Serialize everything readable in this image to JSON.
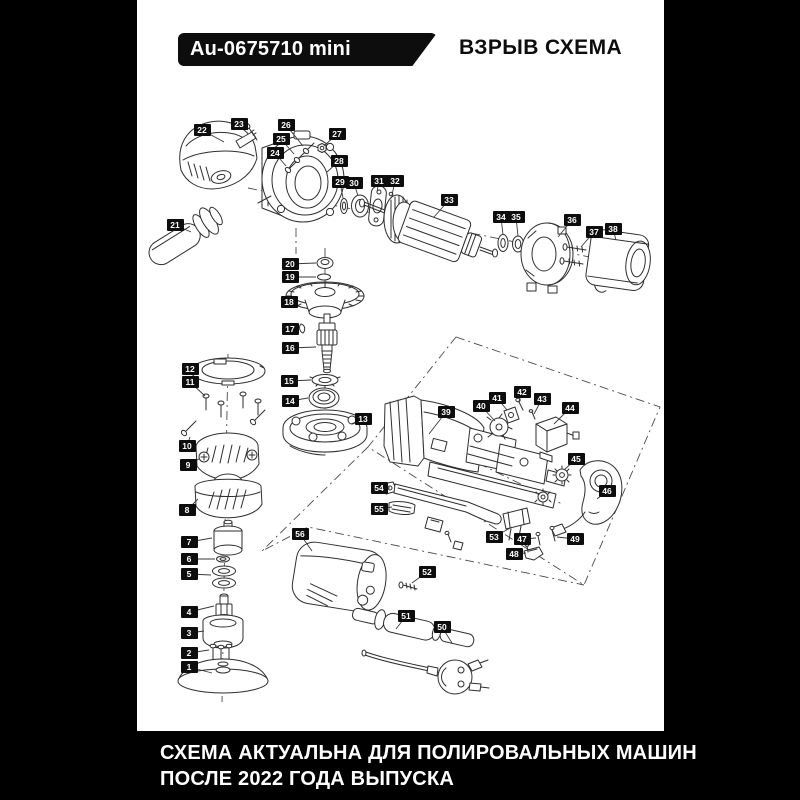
{
  "header": {
    "model_badge": "Au-0675710 mini",
    "title": "ВЗРЫВ СХЕМА"
  },
  "footer": {
    "line1": "СХЕМА АКТУАЛЬНА ДЛЯ ПОЛИРОВАЛЬНЫХ МАШИН",
    "line2": "ПОСЛЕ 2022 ГОДА ВЫПУСКА"
  },
  "colors": {
    "background": "#000000",
    "sheet": "#ffffff",
    "label_bg": "#0d0d0d",
    "label_text": "#ffffff",
    "line_art": "#2e2e2e"
  },
  "diagram": {
    "type": "exploded-parts-diagram",
    "part_count": 56,
    "parts": [
      {
        "n": 1,
        "lx": 189,
        "ly": 667,
        "tx": 212,
        "ty": 673
      },
      {
        "n": 2,
        "lx": 189,
        "ly": 653,
        "tx": 209,
        "ty": 650
      },
      {
        "n": 3,
        "lx": 189,
        "ly": 633,
        "tx": 204,
        "ty": 631
      },
      {
        "n": 4,
        "lx": 189,
        "ly": 612,
        "tx": 214,
        "ty": 606
      },
      {
        "n": 5,
        "lx": 189,
        "ly": 574,
        "tx": 211,
        "ty": 575
      },
      {
        "n": 6,
        "lx": 189,
        "ly": 559,
        "tx": 215,
        "ty": 559
      },
      {
        "n": 7,
        "lx": 189,
        "ly": 542,
        "tx": 212,
        "ty": 538
      },
      {
        "n": 8,
        "lx": 187,
        "ly": 510,
        "tx": 198,
        "ty": 499
      },
      {
        "n": 9,
        "lx": 188,
        "ly": 465,
        "tx": 199,
        "ty": 459
      },
      {
        "n": 10,
        "lx": 187,
        "ly": 446,
        "tx": 190,
        "ty": 437
      },
      {
        "n": 11,
        "lx": 190,
        "ly": 382,
        "tx": 205,
        "ty": 396
      },
      {
        "n": 12,
        "lx": 190,
        "ly": 369,
        "tx": 194,
        "ty": 369
      },
      {
        "n": 13,
        "lx": 363,
        "ly": 419,
        "tx": 351,
        "ty": 424
      },
      {
        "n": 14,
        "lx": 290,
        "ly": 401,
        "tx": 308,
        "ty": 398
      },
      {
        "n": 15,
        "lx": 289,
        "ly": 381,
        "tx": 311,
        "ty": 380
      },
      {
        "n": 16,
        "lx": 290,
        "ly": 348,
        "tx": 316,
        "ty": 347
      },
      {
        "n": 17,
        "lx": 290,
        "ly": 329,
        "tx": 298,
        "ty": 328
      },
      {
        "n": 18,
        "lx": 289,
        "ly": 302,
        "tx": 293,
        "ty": 298
      },
      {
        "n": 19,
        "lx": 290,
        "ly": 277,
        "tx": 316,
        "ty": 277
      },
      {
        "n": 20,
        "lx": 290,
        "ly": 264,
        "tx": 316,
        "ty": 263
      },
      {
        "n": 21,
        "lx": 175,
        "ly": 225,
        "tx": 191,
        "ty": 232
      },
      {
        "n": 22,
        "lx": 202,
        "ly": 130,
        "tx": 224,
        "ty": 142
      },
      {
        "n": 23,
        "lx": 239,
        "ly": 124,
        "tx": 248,
        "ty": 130
      },
      {
        "n": 24,
        "lx": 275,
        "ly": 153,
        "tx": 286,
        "ty": 166
      },
      {
        "n": 25,
        "lx": 281,
        "ly": 139,
        "tx": 294,
        "ty": 154
      },
      {
        "n": 26,
        "lx": 286,
        "ly": 125,
        "tx": 303,
        "ty": 146
      },
      {
        "n": 27,
        "lx": 337,
        "ly": 134,
        "tx": 324,
        "ty": 146
      },
      {
        "n": 28,
        "lx": 339,
        "ly": 161,
        "tx": 327,
        "ty": 172
      },
      {
        "n": 29,
        "lx": 340,
        "ly": 182,
        "tx": 343,
        "ty": 198
      },
      {
        "n": 30,
        "lx": 354,
        "ly": 183,
        "tx": 358,
        "ty": 196
      },
      {
        "n": 31,
        "lx": 379,
        "ly": 181,
        "tx": 377,
        "ty": 192
      },
      {
        "n": 32,
        "lx": 395,
        "ly": 181,
        "tx": 392,
        "ty": 195
      },
      {
        "n": 33,
        "lx": 449,
        "ly": 200,
        "tx": 434,
        "ty": 217
      },
      {
        "n": 34,
        "lx": 501,
        "ly": 217,
        "tx": 503,
        "ty": 235
      },
      {
        "n": 35,
        "lx": 516,
        "ly": 217,
        "tx": 518,
        "ty": 236
      },
      {
        "n": 36,
        "lx": 572,
        "ly": 220,
        "tx": 558,
        "ty": 237
      },
      {
        "n": 37,
        "lx": 594,
        "ly": 232,
        "tx": 581,
        "ty": 247
      },
      {
        "n": 38,
        "lx": 613,
        "ly": 229,
        "tx": 616,
        "ty": 240
      },
      {
        "n": 39,
        "lx": 446,
        "ly": 412,
        "tx": 429,
        "ty": 434
      },
      {
        "n": 40,
        "lx": 481,
        "ly": 406,
        "tx": 495,
        "ty": 421
      },
      {
        "n": 41,
        "lx": 497,
        "ly": 398,
        "tx": 507,
        "ty": 410
      },
      {
        "n": 42,
        "lx": 522,
        "ly": 392,
        "tx": 519,
        "ty": 401
      },
      {
        "n": 43,
        "lx": 542,
        "ly": 399,
        "tx": 534,
        "ty": 414
      },
      {
        "n": 44,
        "lx": 570,
        "ly": 408,
        "tx": 554,
        "ty": 424
      },
      {
        "n": 45,
        "lx": 576,
        "ly": 459,
        "tx": 564,
        "ty": 470
      },
      {
        "n": 46,
        "lx": 607,
        "ly": 491,
        "tx": 597,
        "ty": 499
      },
      {
        "n": 47,
        "lx": 522,
        "ly": 539,
        "tx": 536,
        "ty": 538
      },
      {
        "n": 48,
        "lx": 514,
        "ly": 554,
        "tx": 526,
        "ty": 553
      },
      {
        "n": 49,
        "lx": 575,
        "ly": 539,
        "tx": 557,
        "ty": 537
      },
      {
        "n": 50,
        "lx": 442,
        "ly": 627,
        "tx": 452,
        "ty": 643
      },
      {
        "n": 51,
        "lx": 406,
        "ly": 616,
        "tx": 396,
        "ty": 629
      },
      {
        "n": 52,
        "lx": 427,
        "ly": 572,
        "tx": 412,
        "ty": 583
      },
      {
        "n": 53,
        "lx": 494,
        "ly": 537,
        "tx": 512,
        "ty": 527
      },
      {
        "n": 54,
        "lx": 379,
        "ly": 488,
        "tx": 390,
        "ty": 488
      },
      {
        "n": 55,
        "lx": 379,
        "ly": 509,
        "tx": 392,
        "ty": 507
      },
      {
        "n": 56,
        "lx": 300,
        "ly": 534,
        "tx": 312,
        "ty": 551
      }
    ]
  }
}
